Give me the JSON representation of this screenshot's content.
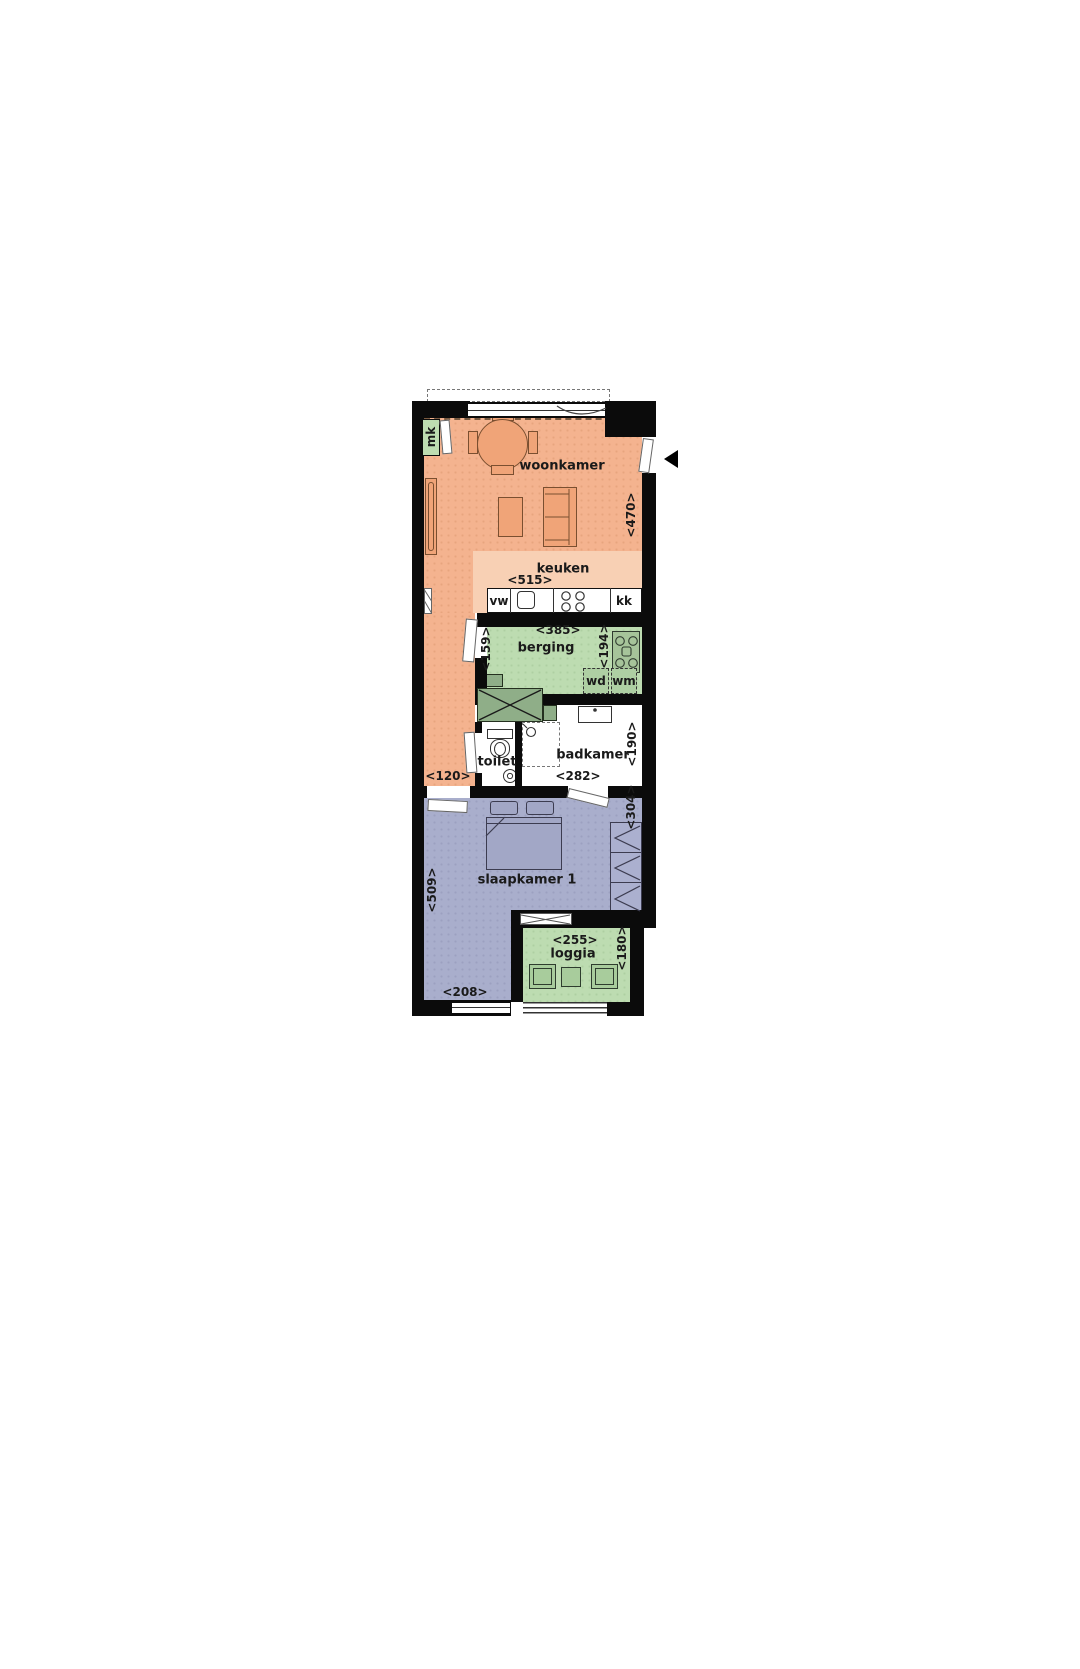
{
  "floorplan": {
    "rooms": {
      "mk": {
        "label": "mk"
      },
      "woonkamer": {
        "label": "woonkamer",
        "dim_depth": "<470>"
      },
      "keuken": {
        "label": "keuken",
        "dim_width": "<515>"
      },
      "berging": {
        "label": "berging",
        "dim_width": "<385>",
        "dim_left": "<159>",
        "dim_right": "<194>"
      },
      "hal": {
        "dim_width": "<120>"
      },
      "toilet": {
        "label": "toilet"
      },
      "badkamer": {
        "label": "badkamer",
        "dim_width": "<282>",
        "dim_depth": "<190>"
      },
      "slaapkamer": {
        "label": "slaapkamer 1",
        "dim_left": "<509>",
        "dim_right": "<304>",
        "dim_bottom": "<208>"
      },
      "loggia": {
        "label": "loggia",
        "dim_width": "<255>",
        "dim_depth": "<180>"
      }
    },
    "appliances": {
      "vaatwasser": "vw",
      "koelkast": "kk",
      "wasdroger": "wd",
      "wasmachine": "wm"
    },
    "colors": {
      "living_orange": "#F4B38F",
      "kitchen_tint": "#F8D0B4",
      "service_green": "#BDDCB1",
      "dark_green": "#8FAE88",
      "bedroom_purple": "#A9AECC",
      "furniture_orange": "#F0A478",
      "wall_black": "#0B0B0B",
      "text": "#1A1A1A"
    }
  }
}
